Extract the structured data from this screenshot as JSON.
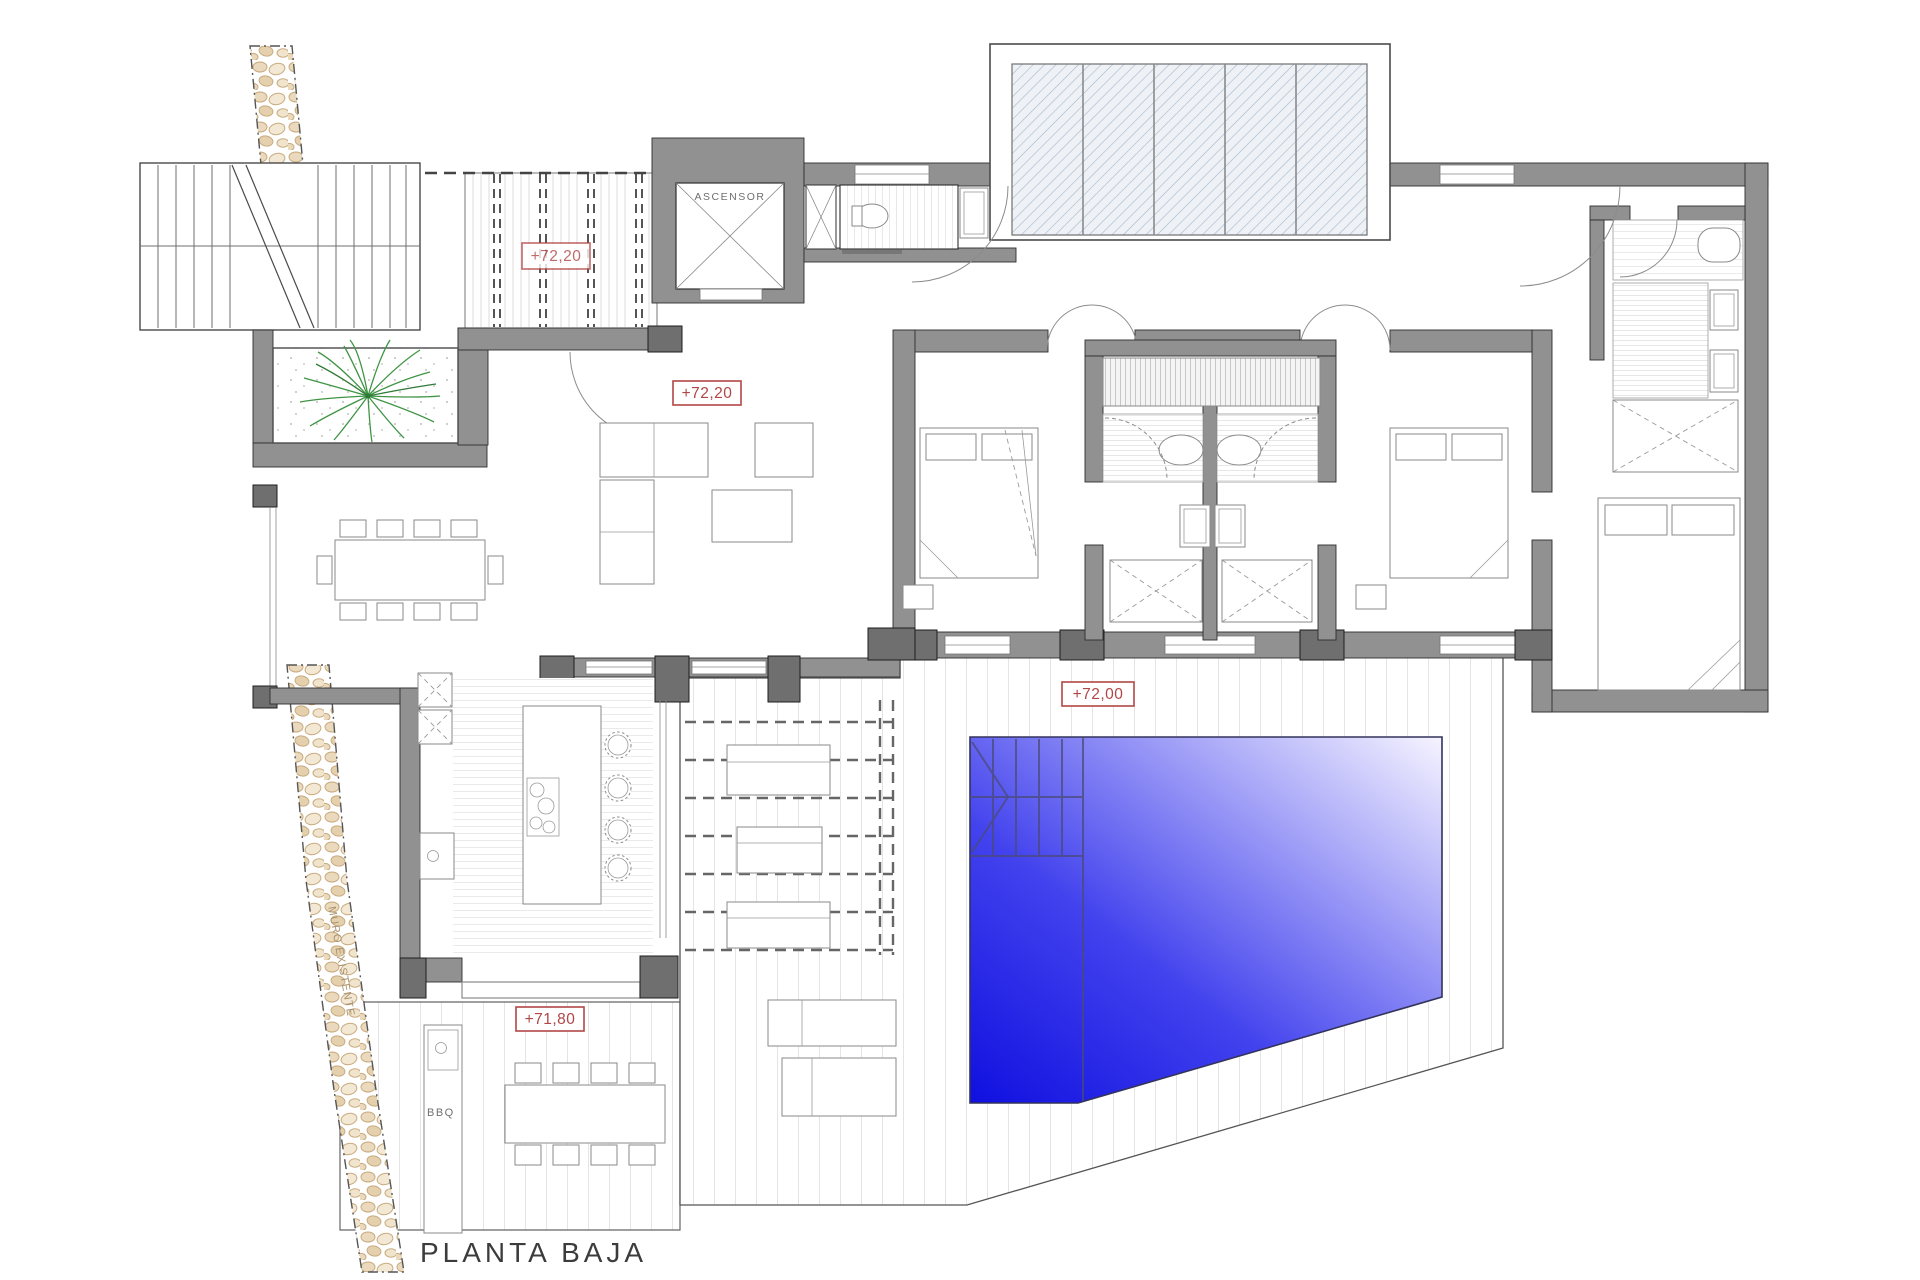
{
  "plan": {
    "title": "PLANTA BAJA",
    "elevator_label": "ASCENSOR",
    "existing_wall_label": "MURO EXISTENTE",
    "bbq_label": "BBQ",
    "levels": {
      "upper_patio": "+72,20",
      "living": "+72,20",
      "deck": "+72,00",
      "terrace": "+71,80"
    },
    "colors": {
      "label_red": "#b24646",
      "pool_deep": "#1414e8",
      "pool_light": "#f4f2ff",
      "wall_gray": "#919191",
      "pier_gray": "#6f6f6f",
      "glass_hatch_blue": "#a5b6c9",
      "pebble_tan": "#d9c3a1",
      "plant_green": "#3f9444",
      "deck_line_gray": "#c9c9c9"
    }
  }
}
